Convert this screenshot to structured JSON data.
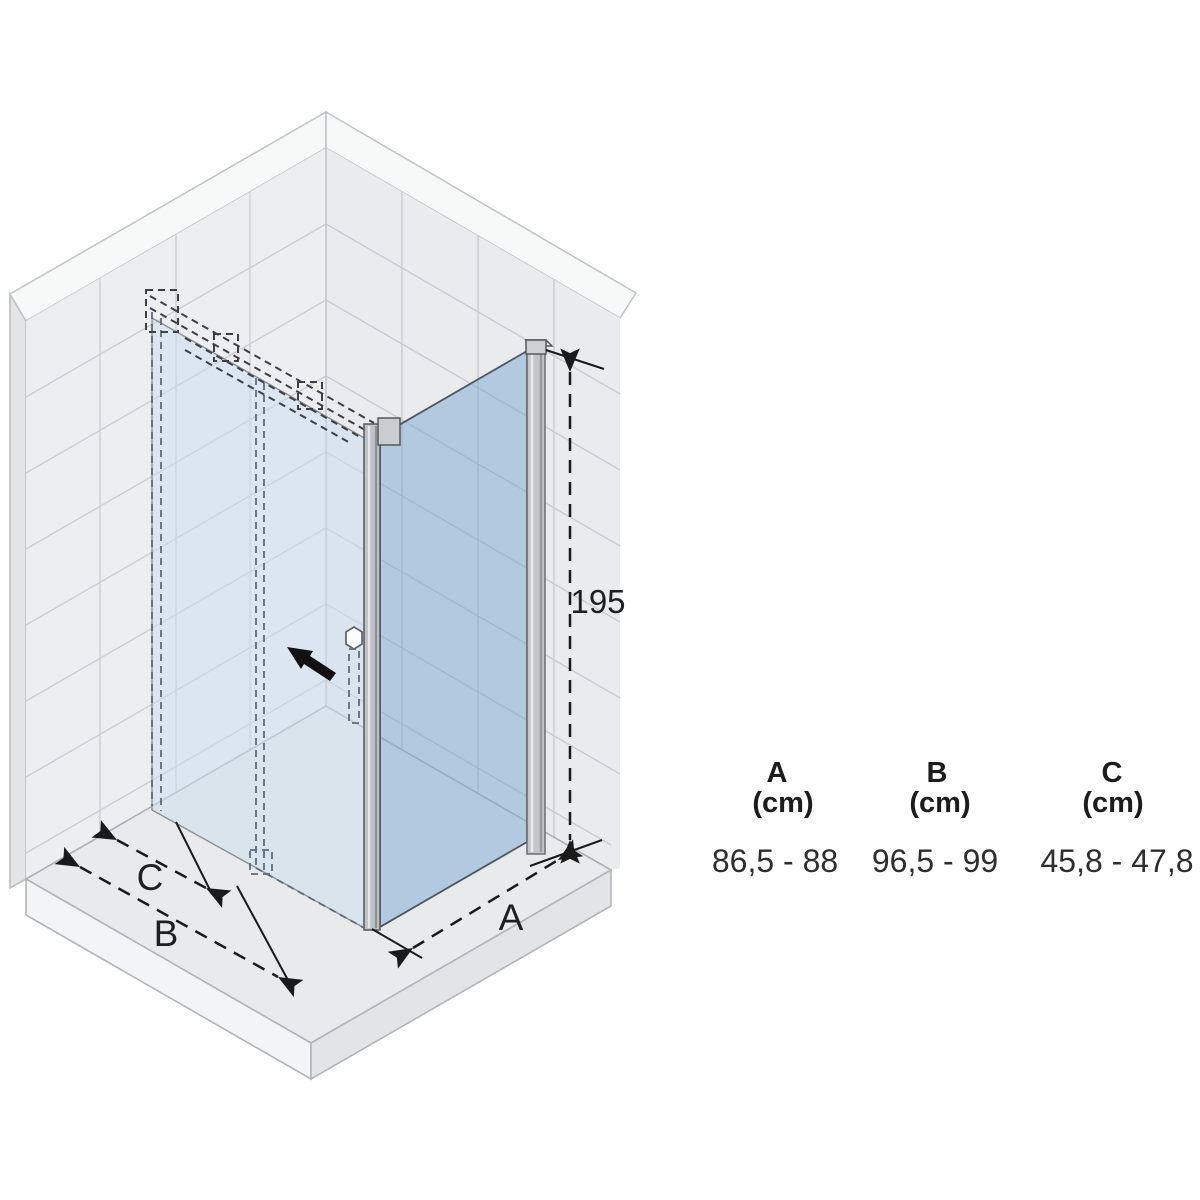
{
  "diagram": {
    "height_label": "195",
    "dim_a_label": "A",
    "dim_b_label": "B",
    "dim_c_label": "C",
    "icons": {
      "slide_direction": "arrow-pointing-up-left"
    },
    "colors": {
      "wall_tile": "#ebedee",
      "wall_grout": "#cbcdd0",
      "wall_top_band": "#f7f8f8",
      "tray_top": "#e8eaeb",
      "tray_face": "#f3f4f5",
      "door_glass": "#dce8f2",
      "side_panel_glass": "#b2cbe1",
      "profile_gray": "#c2c6c9",
      "dimension_ink": "#1a1a1a"
    }
  },
  "table": {
    "columns": [
      {
        "dim": "A",
        "unit": "(cm)",
        "range": "86,5 - 88"
      },
      {
        "dim": "B",
        "unit": "(cm)",
        "range": "96,5 - 99"
      },
      {
        "dim": "C",
        "unit": "(cm)",
        "range": "45,8 - 47,8"
      }
    ]
  }
}
